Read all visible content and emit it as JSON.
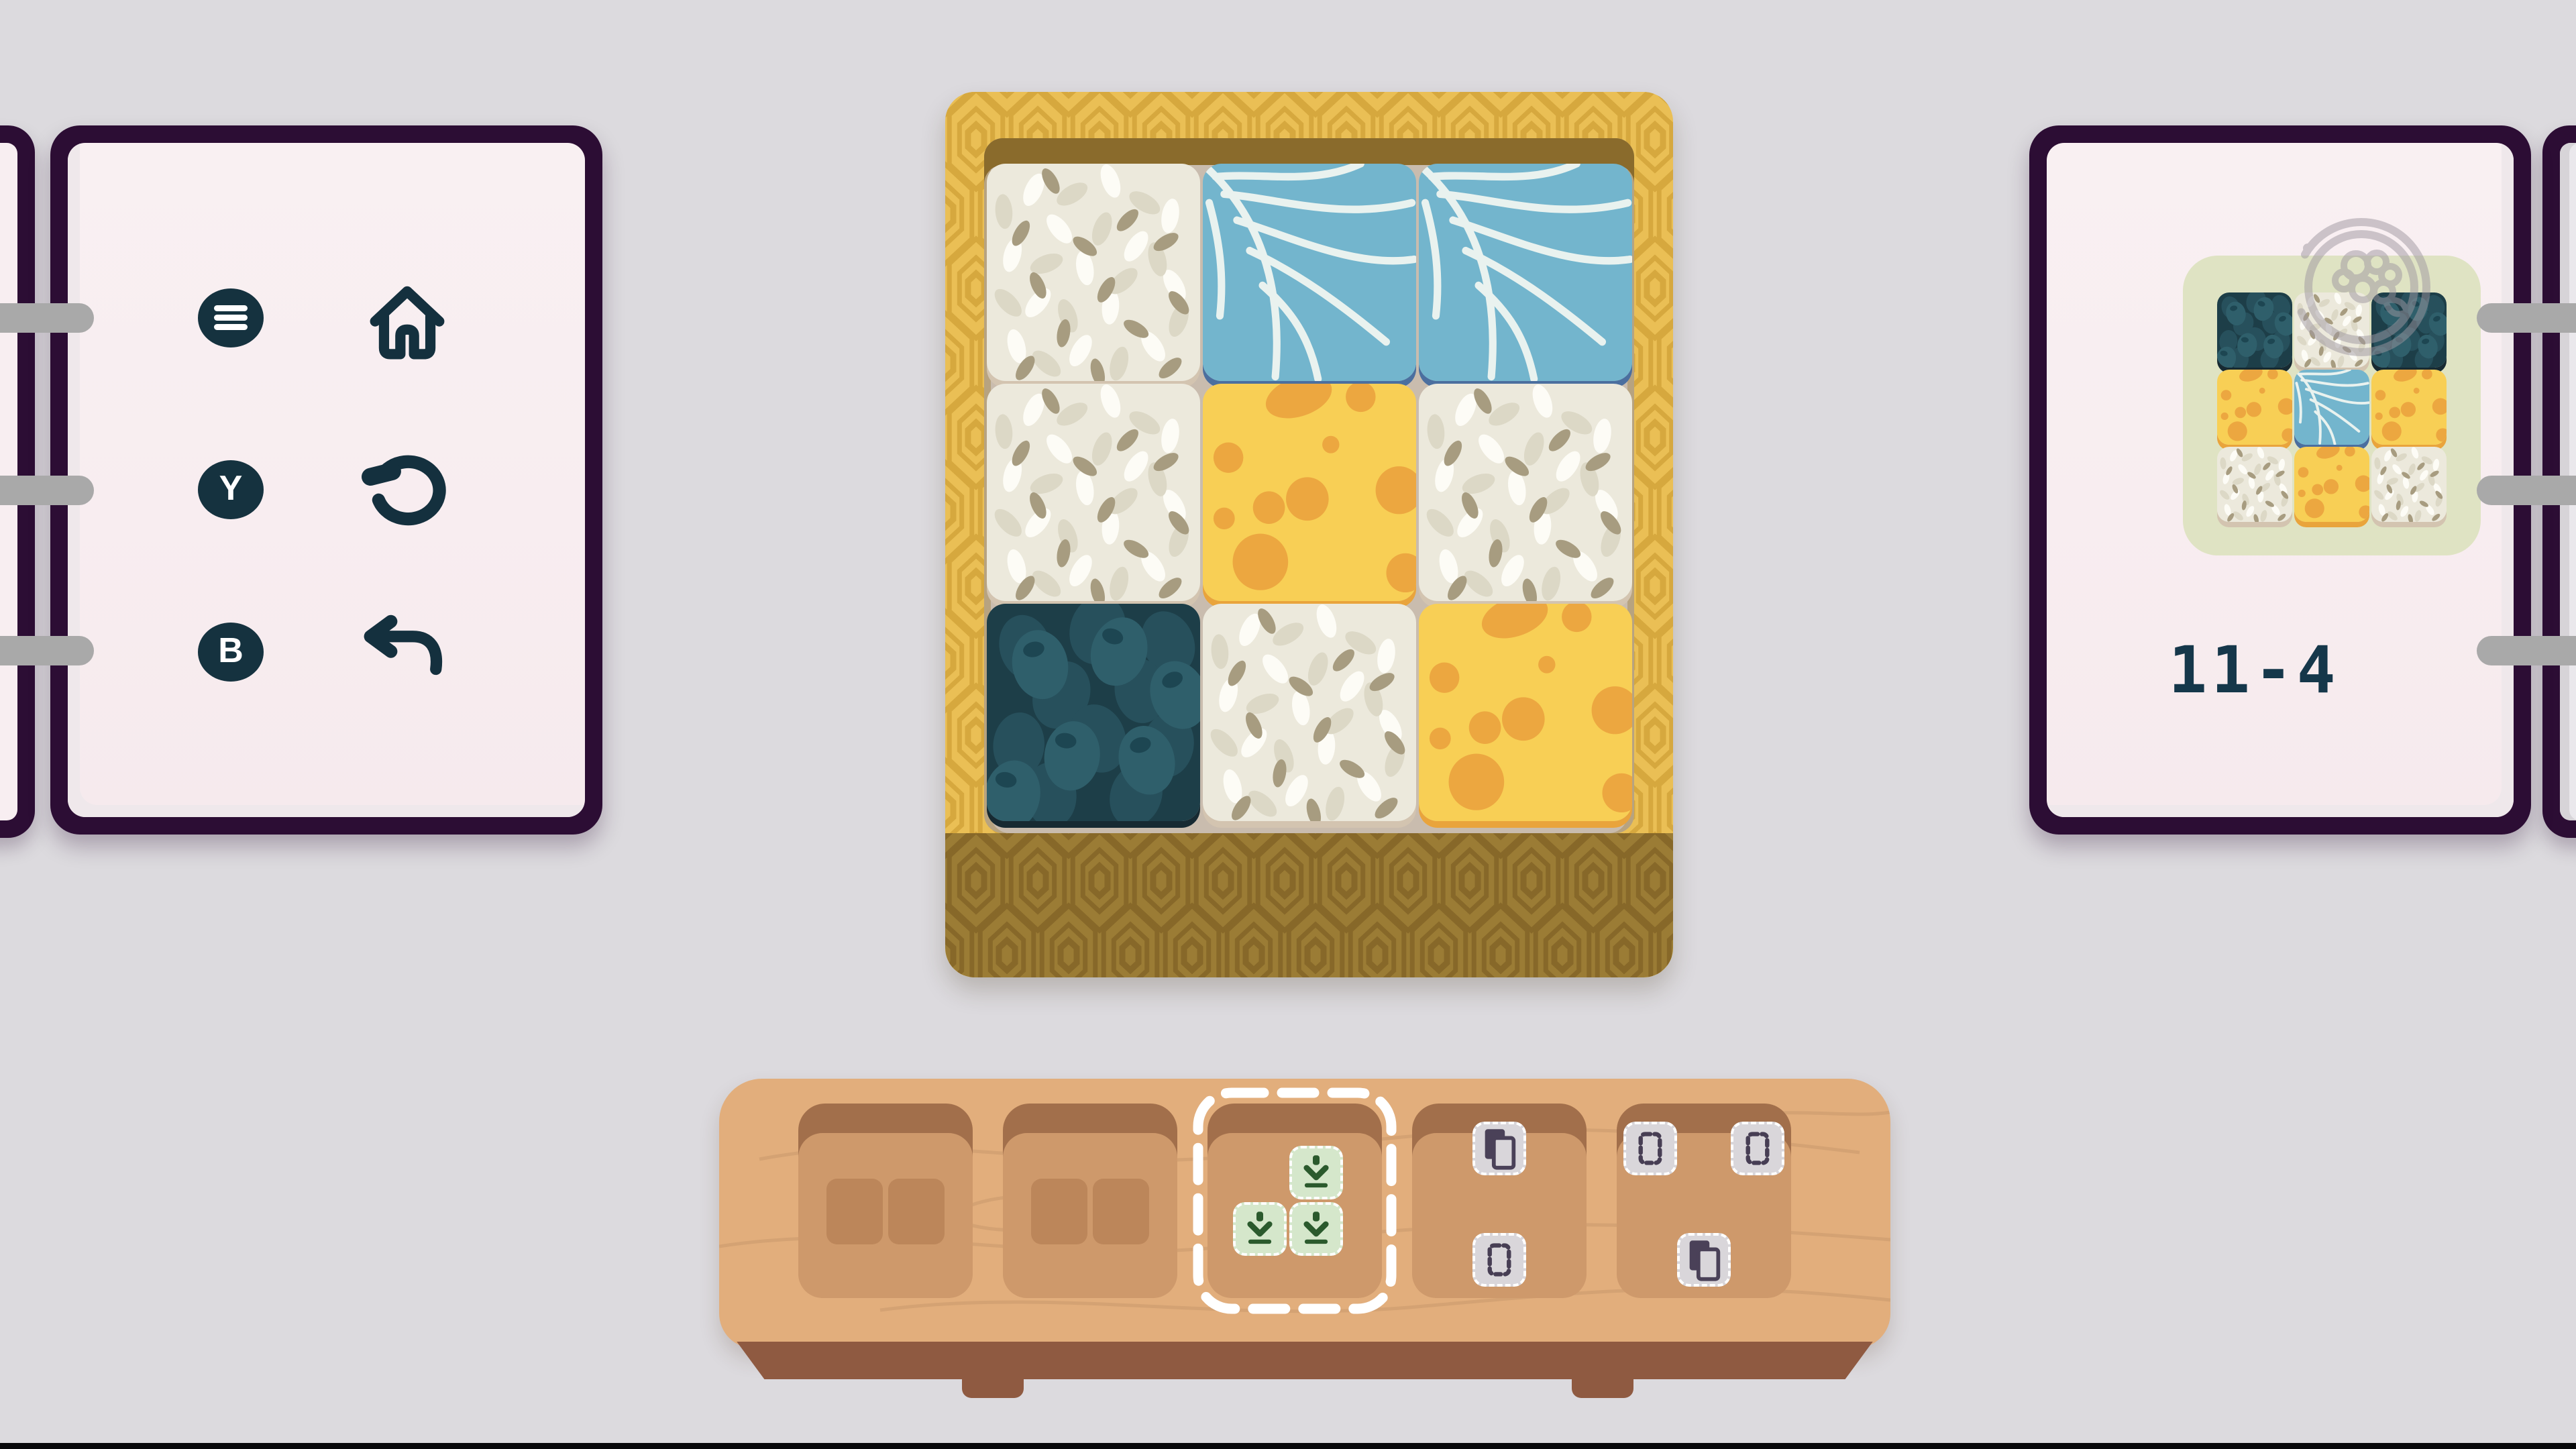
{
  "palette": {
    "background": "#dcdade",
    "notebook_cover": "#2c0d34",
    "notebook_page": "#f8eef1",
    "ring_gray": "#a9a9a9",
    "control_navy": "#15323f",
    "box_gold": "#eabf55",
    "box_front_olive": "#9b7c35",
    "recess_floor": "#c9bcae",
    "tray_wood": "#e2ae7c",
    "tray_base_brown": "#8f5a41",
    "slot_recess": "#ce996b",
    "spent_tile": "#bc865a",
    "piece_green": "#d5e7cb",
    "piece_green_icon": "#2b5a2d",
    "ghost_tile": "#d9d6da",
    "ghost_icon": "#473e54",
    "goal_card_sage": "#dfe3c3",
    "stamp_gray": "#9e97a0",
    "level_text": "#15374a",
    "tile_rice": "#ece9dc",
    "tile_leaf": "#73b5cd",
    "tile_cheese": "#f8cf55",
    "tile_olives": "#1d3e48"
  },
  "left_panel": {
    "controls": [
      {
        "name": "menu",
        "icon": "hamburger-icon",
        "hint": ""
      },
      {
        "name": "home",
        "icon": "home-icon",
        "hint": ""
      },
      {
        "name": "restart",
        "icon": "restart-icon",
        "hint": "Y"
      },
      {
        "name": "undo",
        "icon": "undo-icon",
        "hint": "B"
      }
    ],
    "hint_y": "Y",
    "hint_b": "B"
  },
  "board": {
    "rows": 3,
    "cols": 3,
    "cells": [
      [
        "rice",
        "leaf",
        "leaf"
      ],
      [
        "rice",
        "cheese",
        "rice"
      ],
      [
        "olives",
        "rice",
        "cheese"
      ]
    ]
  },
  "goal": {
    "level_label": "11-4",
    "rows": 3,
    "cols": 3,
    "cells": [
      [
        "olives",
        "rice",
        "olives"
      ],
      [
        "cheese",
        "leaf",
        "cheese"
      ],
      [
        "rice",
        "cheese",
        "rice"
      ]
    ]
  },
  "tray": {
    "slots": [
      {
        "id": 1,
        "state": "spent",
        "content": {
          "type": "pair"
        }
      },
      {
        "id": 2,
        "state": "spent",
        "content": {
          "type": "pair"
        }
      },
      {
        "id": 3,
        "state": "selected",
        "piece": {
          "icon": "push-down-icon",
          "cells": [
            {
              "row": 0,
              "col": 1
            },
            {
              "row": 1,
              "col": 0
            },
            {
              "row": 1,
              "col": 1
            }
          ]
        }
      },
      {
        "id": 4,
        "state": "available",
        "piece": {
          "icon_tiles": [
            {
              "pos": "top-center",
              "icon": "copy-icon"
            },
            {
              "pos": "bottom-center",
              "icon": "dashed-box-icon"
            }
          ]
        }
      },
      {
        "id": 5,
        "state": "available",
        "piece": {
          "icon_tiles": [
            {
              "pos": "top-left",
              "icon": "dashed-box-icon"
            },
            {
              "pos": "top-right",
              "icon": "dashed-box-icon"
            },
            {
              "pos": "bottom-center",
              "icon": "copy-icon"
            }
          ]
        }
      }
    ]
  }
}
